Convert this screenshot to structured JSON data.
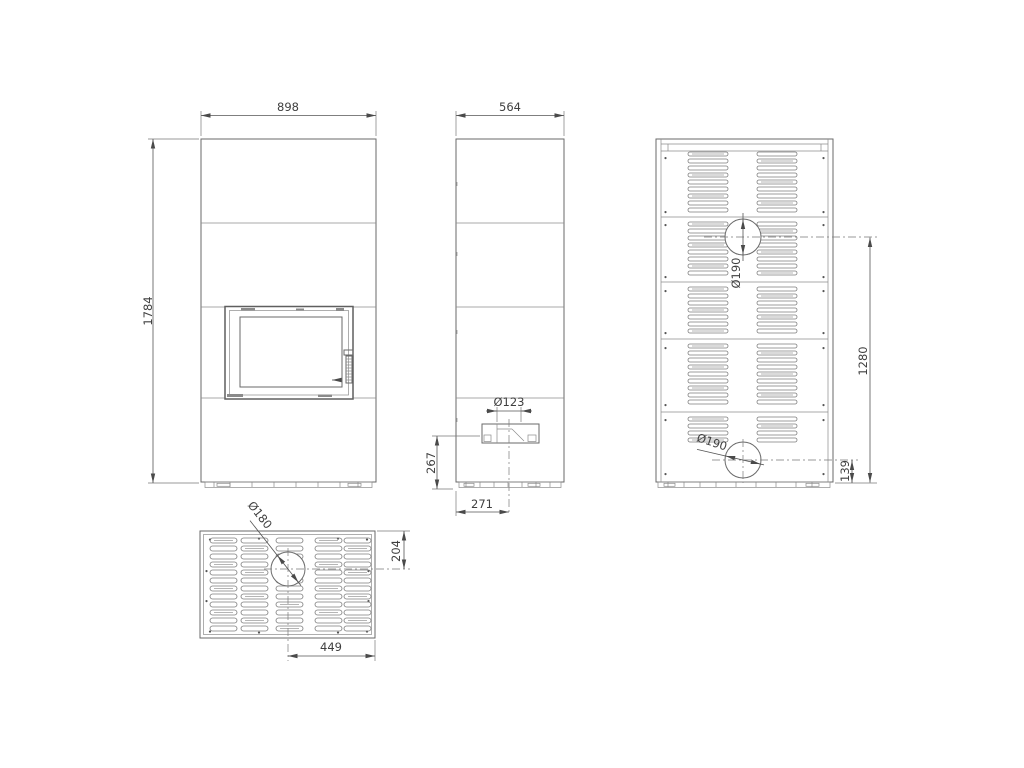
{
  "drawing": {
    "background": "#ffffff",
    "line_color": "#6a6a6a",
    "dim_color": "#555555",
    "text_color": "#3f3f3f",
    "views": {
      "front": {
        "width_dim": "898",
        "height_dim": "1784"
      },
      "side": {
        "width_dim": "564",
        "air_intake_diameter": "Ø123",
        "intake_center_height": "267",
        "intake_center_offset": "271"
      },
      "rear": {
        "upper_flue_diameter": "Ø190",
        "upper_flue_height": "1280",
        "lower_flue_diameter": "Ø190",
        "lower_flue_height": "139"
      },
      "top": {
        "flue_diameter": "Ø180",
        "flue_center_from_rear": "204",
        "flue_center_from_side": "449"
      }
    }
  }
}
